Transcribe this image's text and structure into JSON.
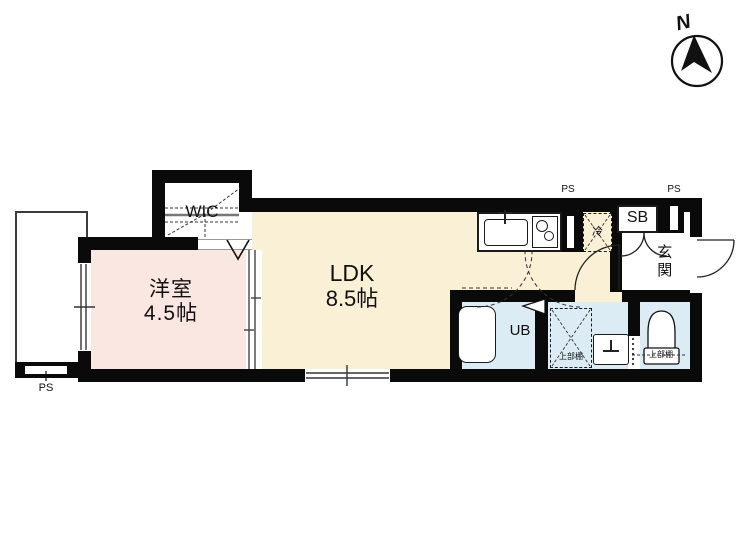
{
  "compass": {
    "label": "N"
  },
  "rooms": {
    "yoshitsu": {
      "name": "洋室",
      "size": "4.5帖"
    },
    "ldk": {
      "name": "LDK",
      "size": "8.5帖"
    },
    "wic": {
      "label": "WIC"
    },
    "ub": {
      "label": "UB"
    },
    "sb": {
      "label": "SB"
    },
    "genkan": {
      "label": "玄関"
    }
  },
  "fixtures": {
    "fridge": {
      "label": "冷"
    },
    "washer_shelf": {
      "label": "上部棚"
    },
    "toilet_shelf": {
      "label": "上部棚"
    }
  },
  "labels": {
    "ps_kitchen": "PS",
    "ps_entrance": "PS",
    "ps_balcony": "PS"
  },
  "colors": {
    "room_pink": "#fbe7e2",
    "room_cream": "#faf0d6",
    "room_blue": "#dcecf5",
    "wall": "#0a0a0a"
  }
}
